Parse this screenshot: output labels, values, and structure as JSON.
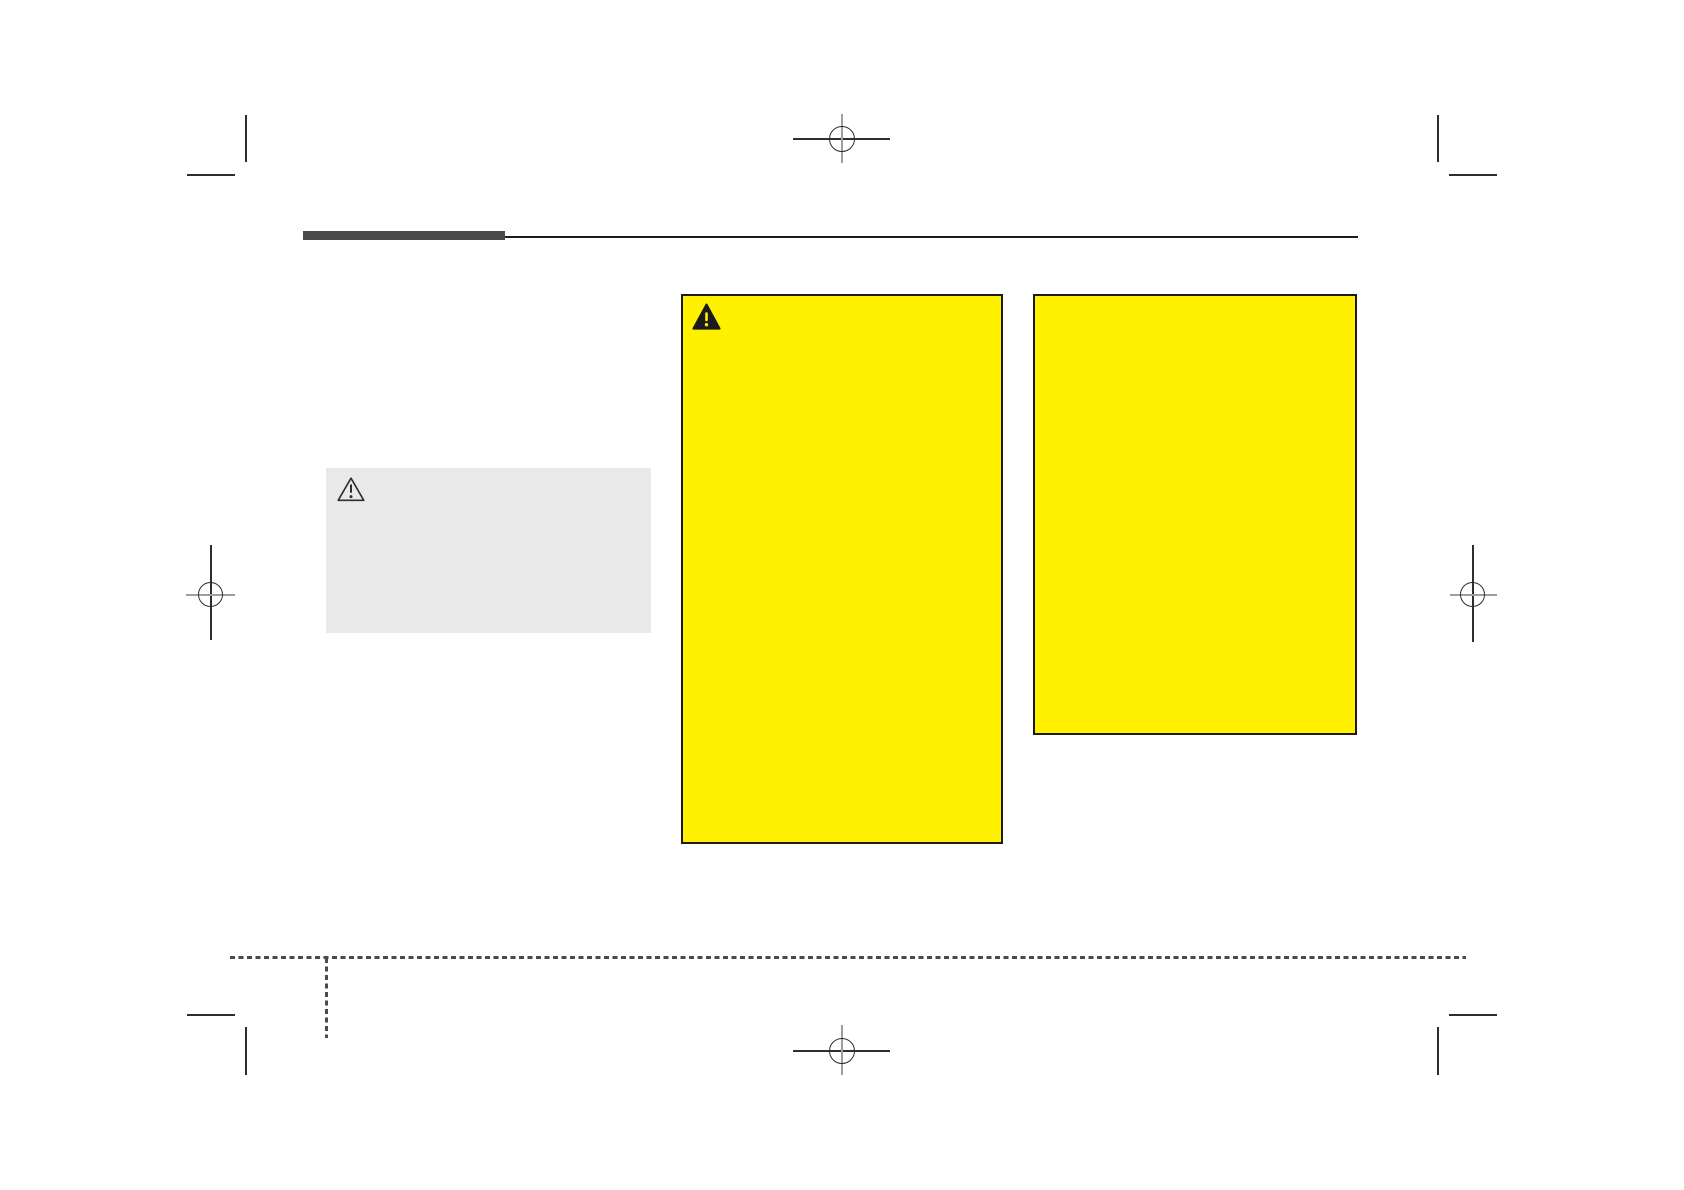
{
  "theme": {
    "page-bg": "#ffffff",
    "warning-yellow": "#fff100",
    "caution-gray": "#e9e9e9",
    "header-bar": "#4b4b4d",
    "rule-ink": "#1b1b1b",
    "mark-dark": "#2e2e2e",
    "mark-light": "#9e9e9e",
    "dash-gray": "#4a4a4a"
  },
  "page": {
    "kind_of_content": "blank manual page layout with print registration marks",
    "visible_text": ""
  },
  "header": {
    "rule_thick_color": "#4b4b4d",
    "rule_thin_color": "#1b1b1b"
  },
  "boxes": {
    "caution": {
      "fill": "#e9e9e9",
      "icon": "warning-triangle-outline",
      "text": ""
    },
    "warning_primary": {
      "fill": "#fff100",
      "border": "#1b1b1b",
      "icon": "warning-triangle-filled",
      "text": ""
    },
    "warning_secondary": {
      "fill": "#fff100",
      "border": "#1b1b1b",
      "icon": "",
      "text": ""
    }
  },
  "print_marks": {
    "registration": [
      "top-center",
      "left-middle",
      "right-middle",
      "bottom-center"
    ],
    "corner_trims": [
      "top-left",
      "top-right",
      "bottom-left",
      "bottom-right"
    ],
    "dashed_guides": [
      "horizontal-bottom",
      "vertical-bottom-left"
    ]
  }
}
